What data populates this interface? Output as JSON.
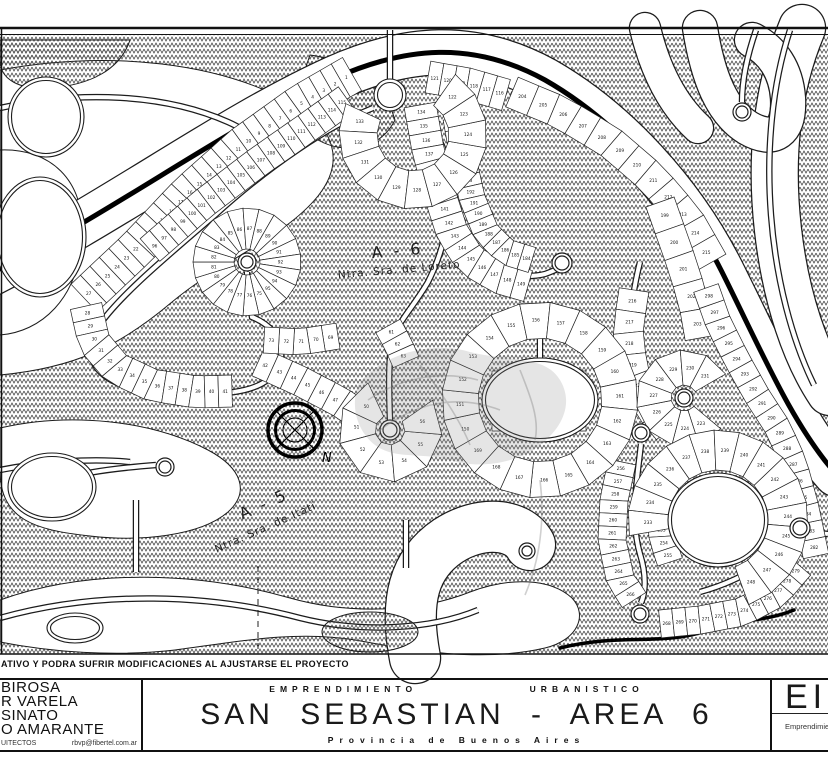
{
  "labels": {
    "area6": {
      "title": "A - 6",
      "subtitle": "Ntra. Sra. de Loreto",
      "x": 398,
      "y": 256,
      "sx": 398,
      "sy": 273,
      "rot": -5
    },
    "area5": {
      "title": "A - 5",
      "subtitle": "Ntra. Sra. de Itatí",
      "x": 266,
      "y": 509,
      "sx": 258,
      "sy": 529,
      "rot": -24
    },
    "north": "N"
  },
  "footer": {
    "disclaimer": "ATIVO Y PODRA SUFRIR MODIFICACIONES AL AJUSTARSE EL PROYECTO",
    "firm": {
      "names": [
        "BIROSA",
        "R VARELA",
        "SINATO",
        "O AMARANTE"
      ],
      "profession": "UITECTOS",
      "email": "rbvp@fibertel.com.ar"
    },
    "title": {
      "top_left": "EMPRENDIMIENTO",
      "top_right": "URBANISTICO",
      "main": "SAN SEBASTIAN - AREA 6",
      "sub": "Provincia de Buenos Aires"
    },
    "sheet": {
      "code": "EI",
      "label": "Emprendimient"
    }
  },
  "map": {
    "frame": {
      "top1": 28,
      "top2": 34.5,
      "bottom": 654,
      "left": 1.5
    },
    "blobs": [
      "M0,70 C110,50 220,62 295,105 C335,128 345,162 318,196 C285,237 225,258 172,302 C120,346 75,368 0,375 Z",
      "M0,150 C50,148 85,180 82,235 C79,300 40,332 0,335 Z",
      "M0,428 C70,412 150,420 208,450 C242,468 250,492 228,512 C200,536 140,542 90,536 C35,530 0,520 0,470 Z",
      "M0,600 C90,568 200,572 290,598 C350,615 420,612 470,592 C510,577 550,578 572,598 C588,615 578,640 545,648 C480,663 410,650 355,640 C295,630 235,642 175,650 C115,657 50,652 0,642 Z"
    ],
    "hatch_patches": [
      "M0,40 L130,40 C120,70 90,85 50,88 C20,90 0,80 0,60 Z",
      "M310,55 C350,60 385,85 395,120 C380,150 345,155 318,140 C300,110 300,80 310,55 Z"
    ],
    "hatch_ellipses": [
      {
        "cx": 370,
        "cy": 632,
        "rx": 48,
        "ry": 20
      }
    ],
    "wideroads": [
      {
        "d": "M-10,274 C120,208 225,128 335,78 C405,47 472,40 545,80 C615,120 682,192 722,272 C762,352 792,424 836,474",
        "w": 44
      },
      {
        "d": "M802,28 C776,90 770,160 778,230 C786,300 806,356 830,392",
        "w": 46
      },
      {
        "d": "M700,28 C708,78 722,112 748,128 C774,143 790,132 788,98 C786,70 772,50 752,40",
        "w": 34
      },
      {
        "d": "M645,28 C655,70 672,104 698,128",
        "w": 30
      },
      {
        "d": "M415,658 C404,600 414,564 448,541 C480,520 518,523 530,545",
        "w": 50
      }
    ],
    "blacklines": [
      {
        "d": "M-10,274 C120,208 225,128 335,78 C405,47 472,40 545,80 C615,120 682,192 722,272 C762,352 792,424 836,474",
        "w": 5
      },
      {
        "d": "M560,648 C620,633 660,646 706,631 C744,618 764,622 794,610",
        "w": 3.5
      }
    ],
    "roads": [
      "M373,108 C330,125 270,165 215,215 C160,262 115,300 96,330 C83,356 94,378 132,388 C166,396 205,396 234,392",
      "M234,392 C262,388 278,377 281,357 C284,338 269,324 252,317 C249,300 247,284 247,272",
      "M390,79 L390,30",
      "M407,110 C436,124 450,152 450,186 C450,222 443,252 428,282 C414,306 398,322 392,340 C388,360 389,395 390,420",
      "M428,108 C438,160 452,212 470,246 C488,272 520,280 545,274 C556,270 560,268 561,265",
      "M540,360 L540,332",
      "M640,262 C630,302 626,346 636,386 C642,406 656,420 674,410",
      "M641,444 C637,480 630,520 640,554 C648,580 644,596 641,603",
      "M800,517 C794,478 780,440 762,408 C748,384 736,362 724,336",
      "M792,538 C768,564 736,582 700,592",
      "M810,532 L828,534",
      "M756,30 C747,56 742,80 742,102",
      "M790,30 C772,85 766,150 771,215 C776,280 792,340 814,385",
      "M136,500 L136,572",
      "M156,465 C118,468 86,472 68,478",
      "M406,520 L406,568",
      "M0,108 C80,90 165,94 228,122 C262,137 272,160 255,180",
      "M0,470 C40,462 90,458 130,462",
      "M0,618 C100,590 210,594 300,618 C360,633 430,630 478,610"
    ],
    "rings": [
      {
        "cx": 46,
        "cy": 117,
        "rx": 38,
        "ry": 40
      },
      {
        "cx": 40,
        "cy": 237,
        "rx": 46,
        "ry": 60
      },
      {
        "cx": 52,
        "cy": 487,
        "rx": 44,
        "ry": 34
      },
      {
        "cx": 75,
        "cy": 628,
        "rx": 28,
        "ry": 15
      },
      {
        "cx": 390,
        "cy": 95,
        "rx": 16,
        "ry": 16
      },
      {
        "cx": 540,
        "cy": 400,
        "rx": 58,
        "ry": 42
      },
      {
        "cx": 718,
        "cy": 520,
        "rx": 50,
        "ry": 47
      }
    ],
    "lollipops": [
      {
        "cx": 742,
        "cy": 112,
        "r": 9
      },
      {
        "cx": 247,
        "cy": 262,
        "r": 9
      },
      {
        "cx": 390,
        "cy": 430,
        "r": 10
      },
      {
        "cx": 562,
        "cy": 263,
        "r": 10
      },
      {
        "cx": 684,
        "cy": 398,
        "r": 9
      },
      {
        "cx": 641,
        "cy": 433,
        "r": 9
      },
      {
        "cx": 640,
        "cy": 614,
        "r": 9
      },
      {
        "cx": 527,
        "cy": 551,
        "r": 8
      },
      {
        "cx": 165,
        "cy": 467,
        "r": 9
      },
      {
        "cx": 800,
        "cy": 528,
        "r": 10
      }
    ],
    "dashed": [
      "M258,566 L258,652"
    ],
    "strips": [
      {
        "pts": [
          [
            352,
            74
          ],
          [
            300,
            104
          ],
          [
            243,
            145
          ],
          [
            188,
            194
          ],
          [
            138,
            247
          ],
          [
            84,
            298
          ]
        ],
        "w": 38,
        "n": 27,
        "start": 1
      },
      {
        "pts": [
          [
            86,
            306
          ],
          [
            94,
            342
          ],
          [
            116,
            368
          ],
          [
            152,
            385
          ],
          [
            196,
            392
          ],
          [
            232,
            391
          ]
        ],
        "w": 32,
        "n": 14,
        "start": 28
      },
      {
        "pts": [
          [
            150,
            250
          ],
          [
            204,
            203
          ],
          [
            258,
            162
          ],
          [
            308,
            127
          ],
          [
            347,
            99
          ]
        ],
        "w": 30,
        "n": 20,
        "start": 96
      },
      {
        "pts": [
          [
            428,
            77
          ],
          [
            468,
            84
          ],
          [
            506,
            95
          ]
        ],
        "w": 32,
        "n": 6,
        "start": 116,
        "rev": true
      },
      {
        "pts": [
          [
            258,
            362
          ],
          [
            300,
            381
          ],
          [
            340,
            402
          ],
          [
            368,
            421
          ]
        ],
        "w": 30,
        "n": 8,
        "start": 42
      },
      {
        "pts": [
          [
            338,
            336
          ],
          [
            300,
            342
          ],
          [
            264,
            340
          ]
        ],
        "w": 26,
        "n": 5,
        "start": 69
      },
      {
        "pts": [
          [
            388,
            326
          ],
          [
            398,
            344
          ],
          [
            406,
            362
          ]
        ],
        "w": 28,
        "n": 3,
        "start": 61
      },
      {
        "pts": [
          [
            420,
            105
          ],
          [
            428,
            150
          ],
          [
            440,
            195
          ],
          [
            452,
            232
          ],
          [
            470,
            260
          ],
          [
            500,
            278
          ],
          [
            528,
            286
          ]
        ],
        "w": 32,
        "n": 16,
        "start": 134
      },
      {
        "pts": [
          [
            456,
            118
          ],
          [
            463,
            158
          ],
          [
            472,
            198
          ],
          [
            486,
            232
          ],
          [
            506,
            252
          ],
          [
            532,
            260
          ]
        ],
        "w": 26,
        "n": 15,
        "start": 184,
        "rev": true
      },
      {
        "pts": [
          [
            492,
            388
          ],
          [
            586,
            388
          ]
        ],
        "w": 34,
        "n": 5,
        "start": 175
      },
      {
        "pts": [
          [
            492,
            414
          ],
          [
            586,
            414
          ]
        ],
        "w": 34,
        "n": 5,
        "start": 170,
        "rev": true
      },
      {
        "pts": [
          [
            512,
            92
          ],
          [
            560,
            112
          ],
          [
            610,
            142
          ],
          [
            652,
            178
          ],
          [
            688,
            220
          ],
          [
            712,
            262
          ]
        ],
        "w": 32,
        "n": 12,
        "start": 204
      },
      {
        "pts": [
          [
            660,
            202
          ],
          [
            672,
            236
          ],
          [
            684,
            270
          ],
          [
            694,
            304
          ],
          [
            700,
            338
          ]
        ],
        "w": 30,
        "n": 5,
        "start": 199
      },
      {
        "pts": [
          [
            634,
            290
          ],
          [
            628,
            330
          ],
          [
            632,
            368
          ],
          [
            646,
            404
          ],
          [
            668,
            430
          ]
        ],
        "w": 30,
        "n": 7,
        "start": 216
      },
      {
        "pts": [
          [
            622,
            462
          ],
          [
            614,
            500
          ],
          [
            612,
            540
          ],
          [
            620,
            578
          ],
          [
            634,
            600
          ]
        ],
        "w": 28,
        "n": 11,
        "start": 256
      },
      {
        "pts": [
          [
            666,
            470
          ],
          [
            660,
            505
          ],
          [
            662,
            538
          ],
          [
            670,
            562
          ]
        ],
        "w": 26,
        "n": 7,
        "start": 249
      },
      {
        "pts": [
          [
            660,
            624
          ],
          [
            700,
            620
          ],
          [
            742,
            612
          ],
          [
            776,
            594
          ],
          [
            800,
            566
          ]
        ],
        "w": 28,
        "n": 12,
        "start": 268
      },
      {
        "pts": [
          [
            816,
            556
          ],
          [
            806,
            508
          ],
          [
            794,
            464
          ],
          [
            778,
            428
          ],
          [
            756,
            394
          ],
          [
            736,
            358
          ],
          [
            718,
            322
          ],
          [
            706,
            288
          ]
        ],
        "w": 26,
        "n": 17,
        "start": 282
      }
    ],
    "fans": [
      {
        "cx": 413,
        "cy": 135,
        "r0": 36,
        "r1": 74,
        "a0": 205,
        "a1": -55,
        "n": 12,
        "start": 122,
        "rev": true
      },
      {
        "cx": 247,
        "cy": 262,
        "r0": 13,
        "r1": 54,
        "a0": 60,
        "a1": 420,
        "n": 21,
        "start": 75
      },
      {
        "cx": 390,
        "cy": 430,
        "r0": 15,
        "r1": 52,
        "a0": 245,
        "a1": -35,
        "n": 7,
        "start": 50
      },
      {
        "cx": 540,
        "cy": 400,
        "r0": 62,
        "r1": 98,
        "a0": 150,
        "a1": 510,
        "n": 20,
        "start": 150
      },
      {
        "cx": 684,
        "cy": 398,
        "r0": 13,
        "r1": 48,
        "a0": 40,
        "a1": 330,
        "n": 9,
        "start": 223
      },
      {
        "cx": 718,
        "cy": 520,
        "r0": 50,
        "r1": 90,
        "a0": 170,
        "a1": 430,
        "n": 16,
        "start": 233
      }
    ],
    "compass": {
      "cx": 295,
      "cy": 430,
      "nx": 322,
      "ny": 462
    },
    "watermark": {
      "blob": "M358,385 C380,355 430,340 470,352 C510,362 545,355 560,380 C575,405 560,430 540,445 C520,462 480,470 450,460 C420,452 395,460 375,445 C358,432 350,408 358,385 Z",
      "strokes": [
        "M380,430 C420,400 460,395 500,410",
        "M420,365 C440,390 460,420 470,445",
        "M520,370 C530,395 540,420 535,440",
        "M368,400 C400,378 440,370 478,380",
        "M540,480 C545,520 540,560 525,595"
      ]
    }
  }
}
